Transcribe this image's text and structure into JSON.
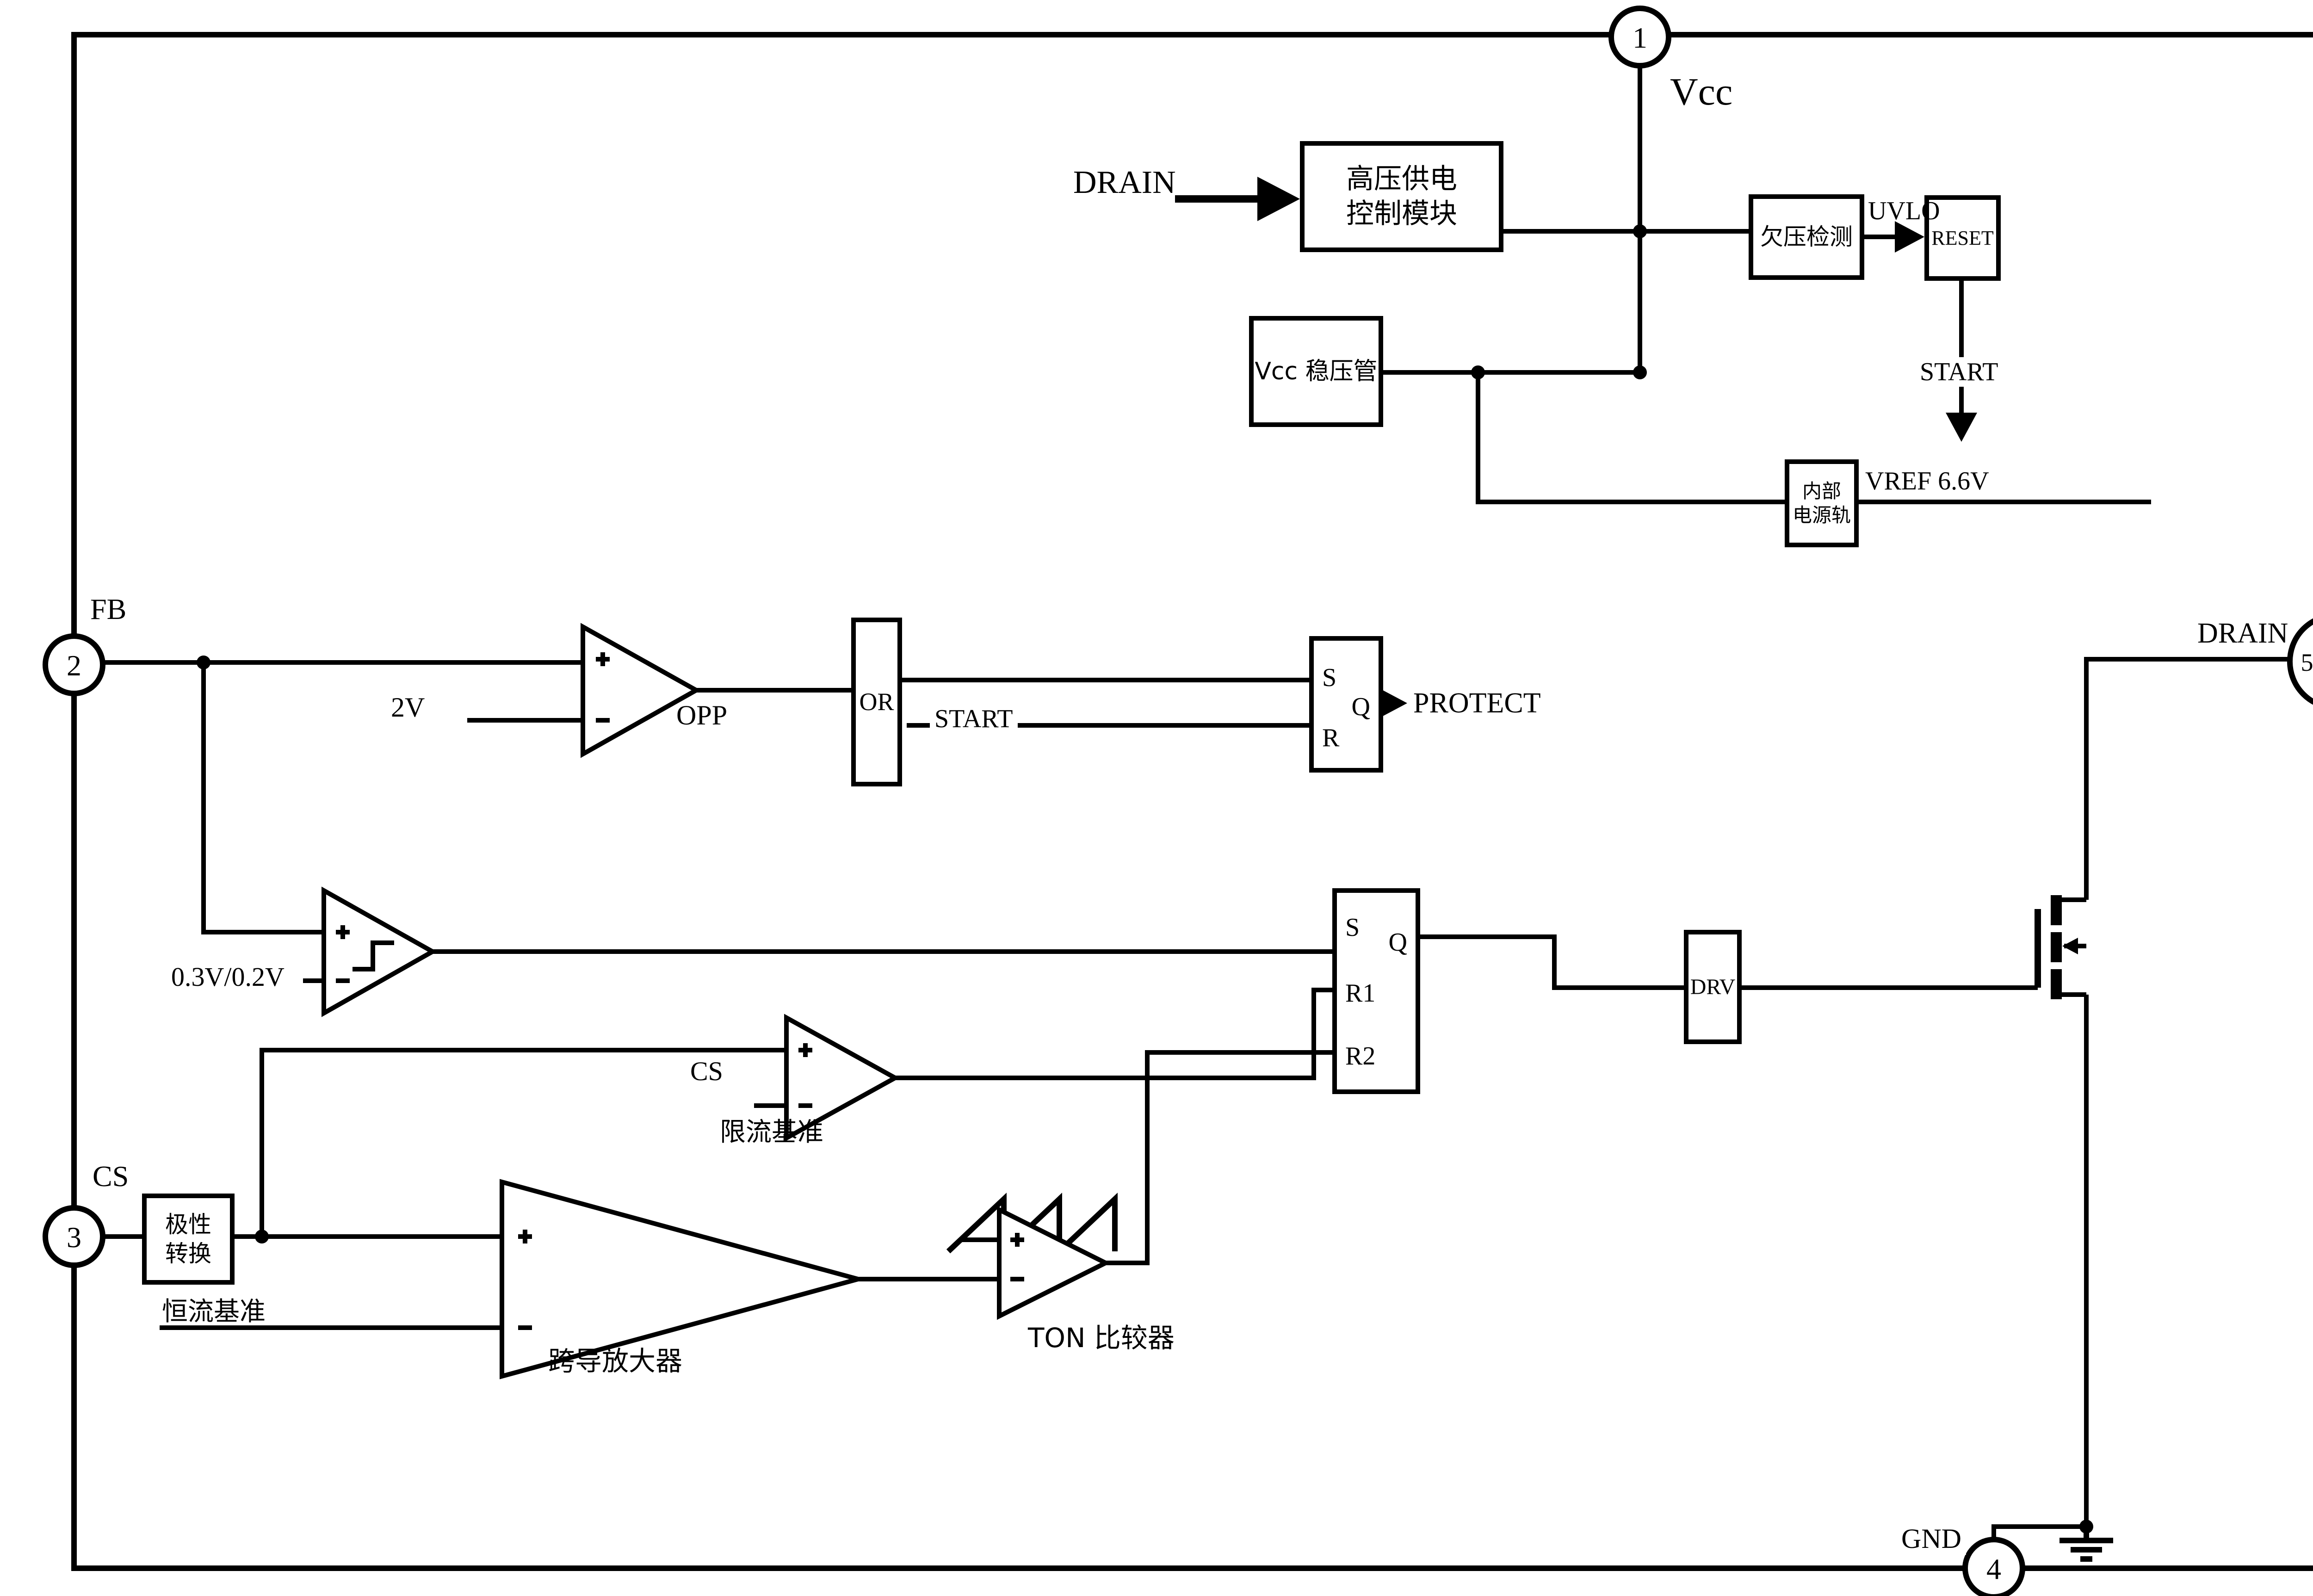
{
  "pins": {
    "vcc": {
      "number": "1",
      "label": "Vcc"
    },
    "fb": {
      "number": "2",
      "label": "FB"
    },
    "cs": {
      "number": "3",
      "label": "CS"
    },
    "gnd": {
      "number": "4",
      "label": "GND"
    },
    "drain": {
      "number": "5/6/7/8",
      "label": "DRAIN"
    }
  },
  "blocks": {
    "hv_supply_module": "高压供电\n控制模块",
    "vcc_regulator": "Vcc 稳压管",
    "undervoltage_detect": "欠压检测",
    "reset": "RESET",
    "internal_rail": "内部\n电源轨",
    "or_gate": "OR",
    "driver": "DRV",
    "polarity_convert": "极性\n转换"
  },
  "latch1": {
    "s": "S",
    "r": "R",
    "q": "Q"
  },
  "latch2": {
    "s": "S",
    "r1": "R1",
    "r2": "R2",
    "q": "Q"
  },
  "signals": {
    "drain_input": "DRAIN",
    "uvlo": "UVLO",
    "start_top": "START",
    "vref": "VREF 6.6V",
    "ovp_threshold": "2V",
    "opp": "OPP",
    "start_mid": "START",
    "protect": "PROTECT",
    "hysteresis_threshold": "0.3V/0.2V",
    "cs_sense": "CS",
    "current_limit_ref": "限流基准",
    "constant_current_ref": "恒流基准",
    "gm_amplifier": "跨导放大器",
    "ton_comparator": "TON 比较器"
  },
  "colors": {
    "line": "#000000",
    "background": "#ffffff"
  }
}
